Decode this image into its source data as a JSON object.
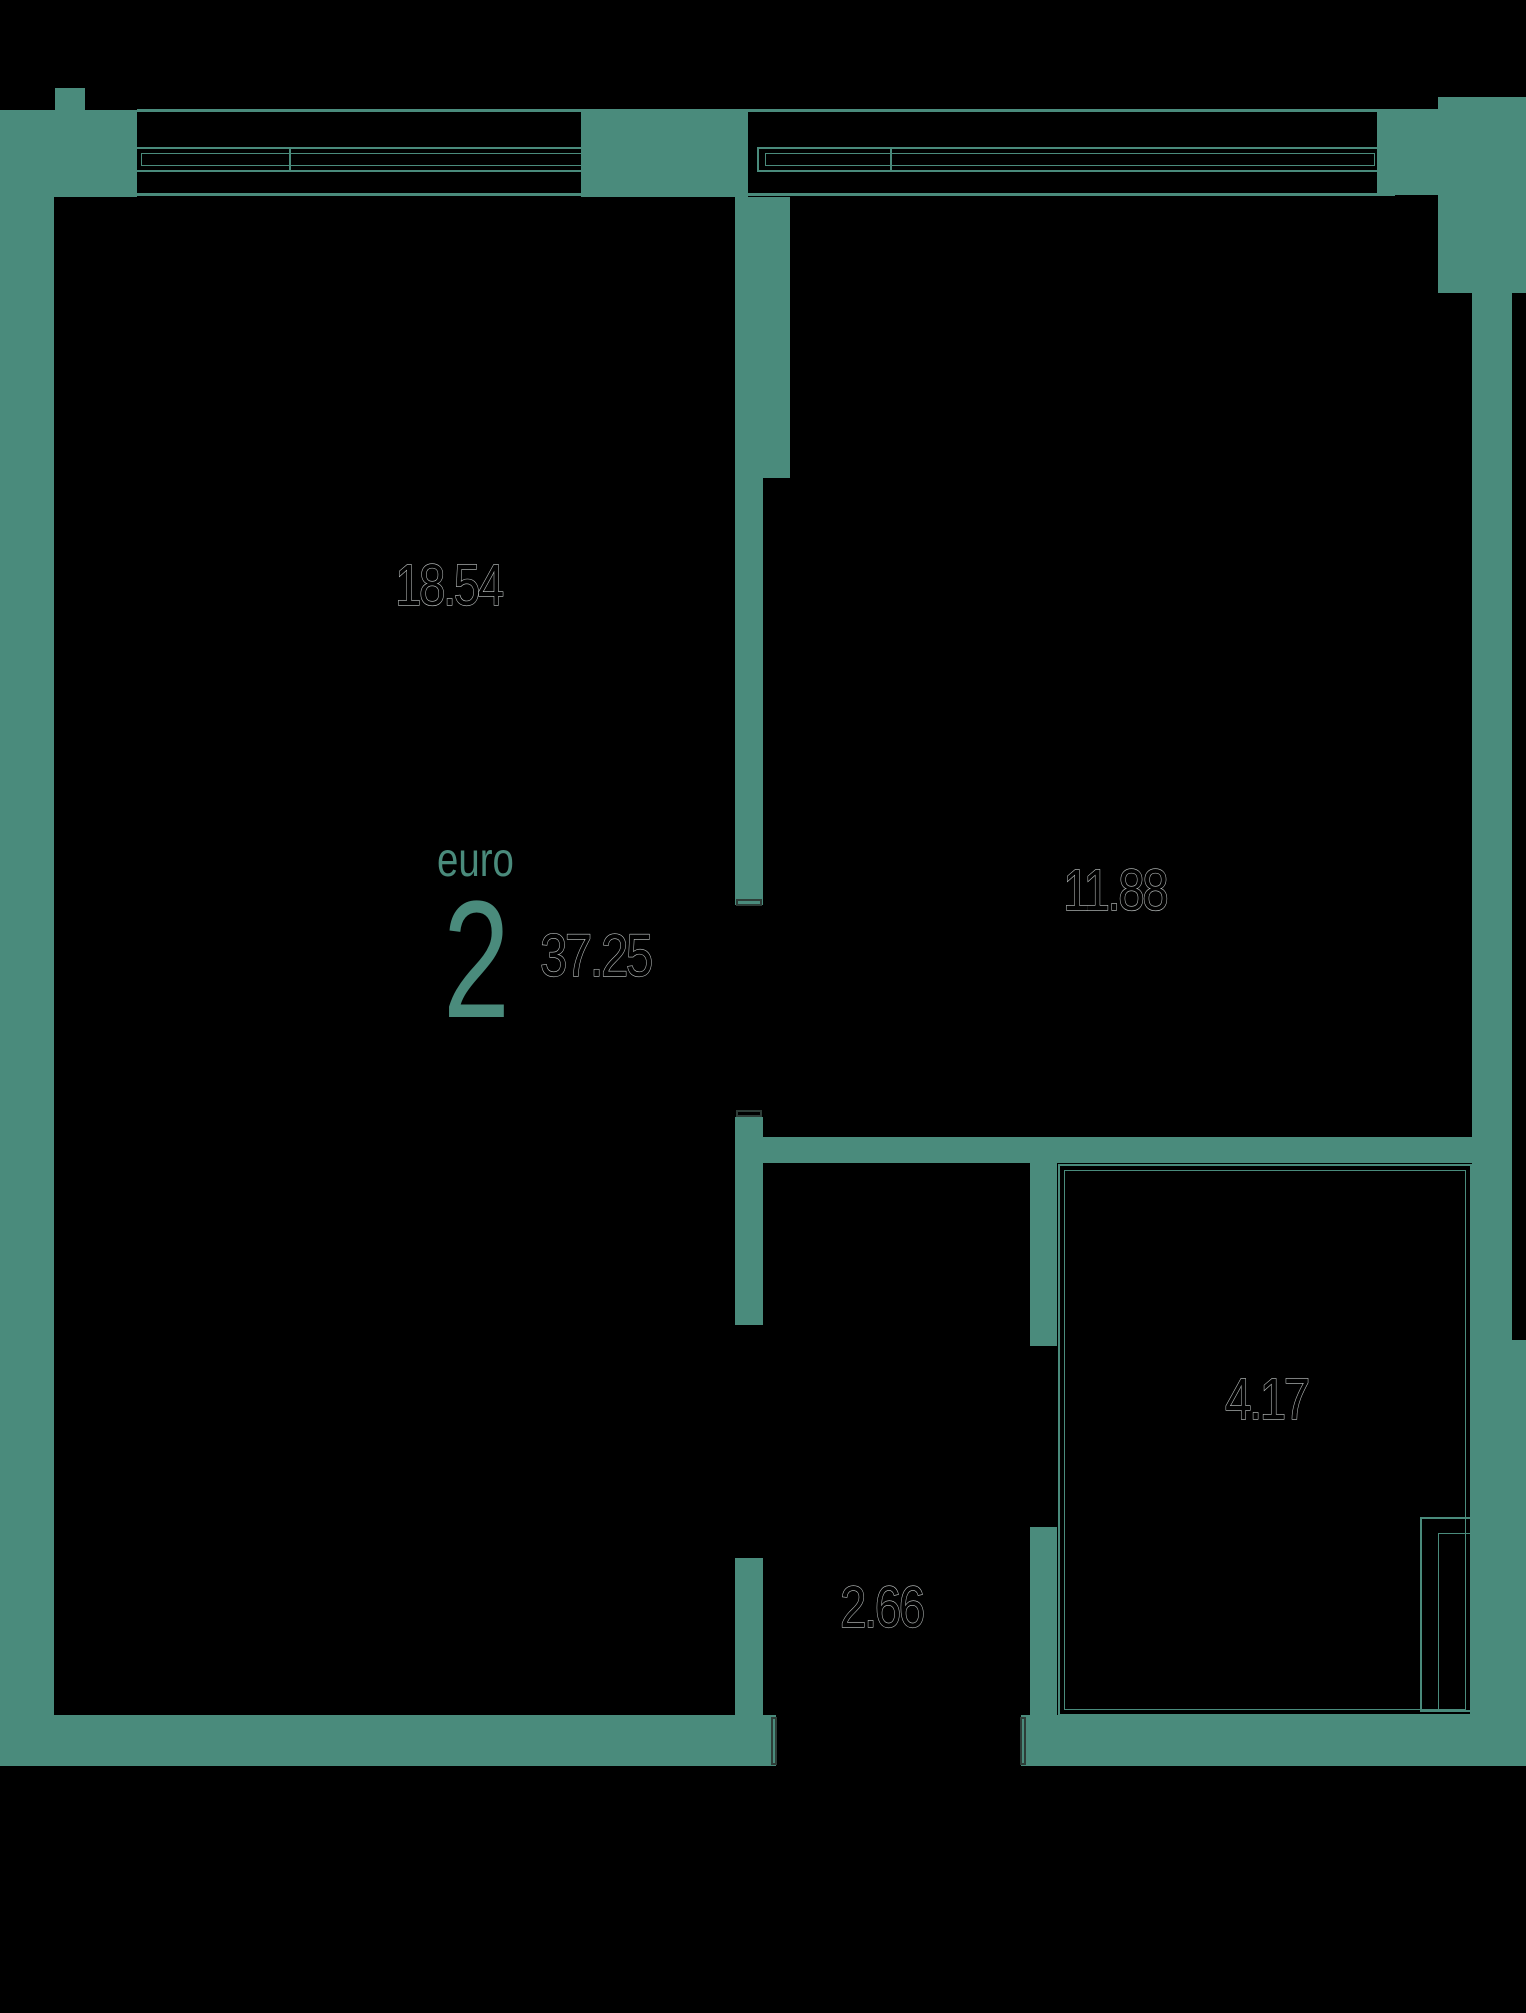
{
  "plan": {
    "unit": {
      "type_label": "euro",
      "rooms_count": "2",
      "total_area": "37.25"
    },
    "rooms": [
      {
        "name": "living-kitchen",
        "area": "18.54"
      },
      {
        "name": "bedroom",
        "area": "11.88"
      },
      {
        "name": "bathroom",
        "area": "4.17"
      },
      {
        "name": "hallway",
        "area": "2.66"
      }
    ],
    "colors": {
      "wall": "#4a8b7c",
      "background": "#000000",
      "label_stroke": "#c2c7c6",
      "door_tick": "#2e3d38"
    }
  }
}
